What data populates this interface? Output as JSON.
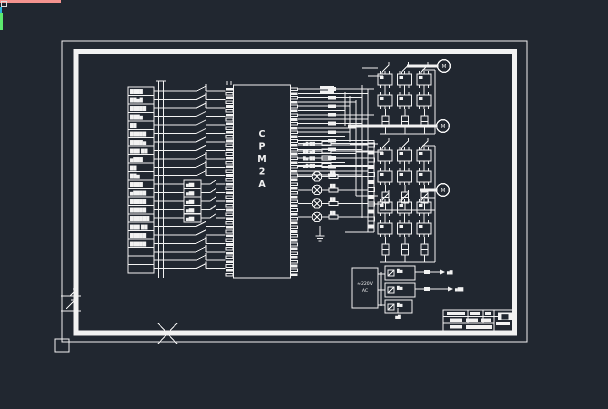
{
  "colors": {
    "background": "#212730",
    "line": "#f2f2f2",
    "accent_pink": "#f4938f",
    "accent_cyan": "#2bb3d9",
    "accent_green": "#5ce96e"
  },
  "plc": {
    "name": "CPM2A",
    "letters": [
      "C",
      "P",
      "M",
      "2",
      "A"
    ]
  },
  "signal_table": {
    "rows": [
      "████",
      "██▆█",
      "█████",
      "███▆",
      "██",
      "█████",
      "████▆",
      "███ ██",
      "▆███",
      "██",
      "██▆",
      "████",
      "▆████",
      "█████",
      "█████",
      "██████",
      "███ ██",
      "█████",
      "█████",
      "",
      "",
      ""
    ]
  },
  "wire_contacts": {
    "types": [
      "nc",
      "nc",
      "nc",
      "no",
      "no",
      "no",
      "no",
      "no",
      "nc",
      "nc",
      "nc",
      "box",
      "box",
      "box",
      "box",
      "box",
      "no",
      "no",
      "nc",
      "nc",
      "nc",
      "nc"
    ],
    "box_label": "▆██"
  },
  "components": {
    "rows": [
      "▆█ ██",
      "██ ▆█",
      "█▆ ██",
      "▆█ ██"
    ],
    "lamp_label": "██"
  },
  "motors": {
    "label": "M",
    "count": 3
  },
  "power": {
    "input_line1": "≈220V",
    "input_line2": "AC",
    "box_labels": [
      "█▆",
      "█▆",
      "█▆"
    ],
    "output_labels": [
      "▆█",
      "▆██"
    ],
    "ground_label": "▆█"
  },
  "title_block": {
    "highlight_text": "██",
    "illegible": true
  }
}
